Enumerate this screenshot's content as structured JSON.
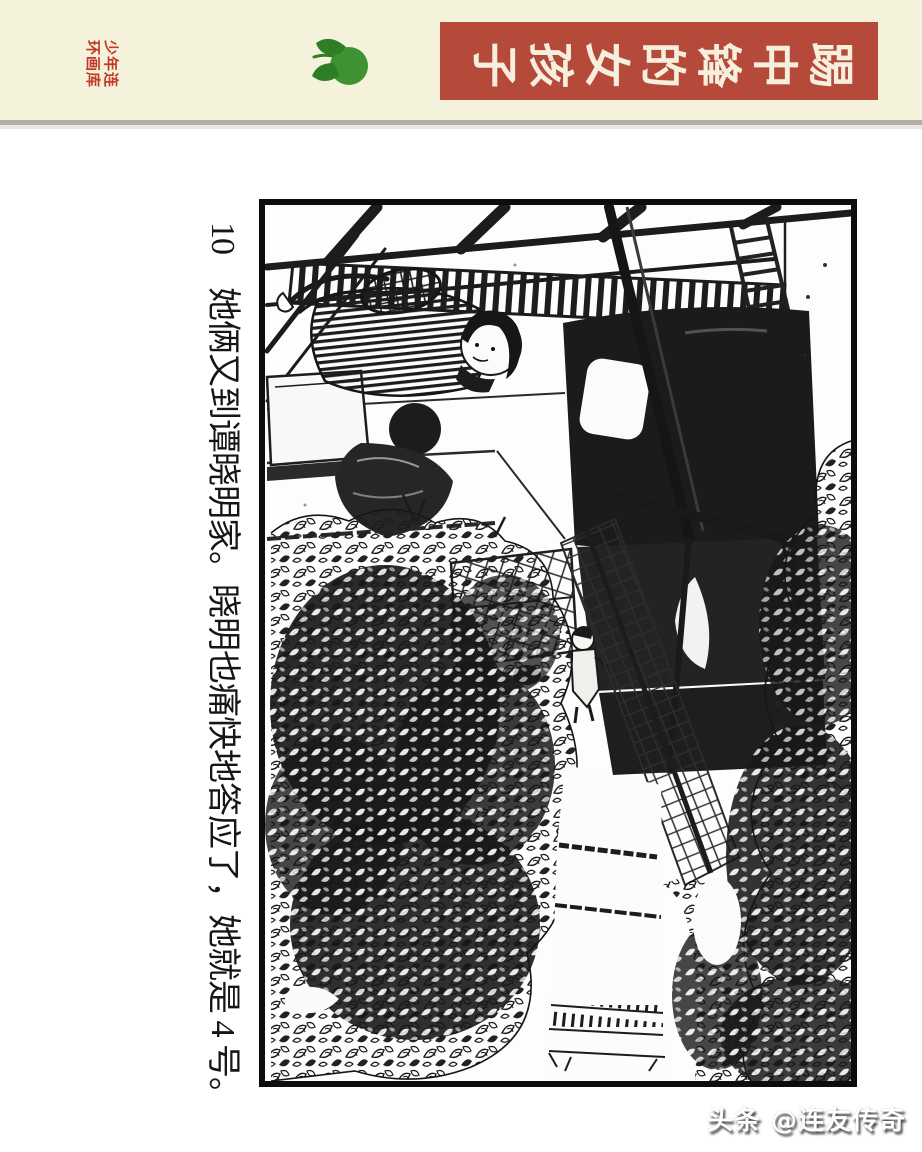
{
  "banner": {
    "background": "#f4f2da",
    "divider_color": "#b0b0a8",
    "series_label": "少年连环画库",
    "series_label_lines": "少年连\n环画库",
    "series_label_color": "#c23b2a",
    "logo_icon": "tangerine-icon",
    "logo_color": "#3e9231",
    "logo_leaf_color": "#2f7d26",
    "title": "踢中锋的女孩子",
    "title_box_color": "#b54a3a",
    "title_text_color": "#f7efdd"
  },
  "comic": {
    "page_number": "10",
    "caption": "10　她俩又到谭晓明家。晓明也痛快地答应了，她就是 4 号。",
    "frame_color": "#0d0d0d"
  },
  "watermark": {
    "text": "头条 @连友传奇"
  }
}
